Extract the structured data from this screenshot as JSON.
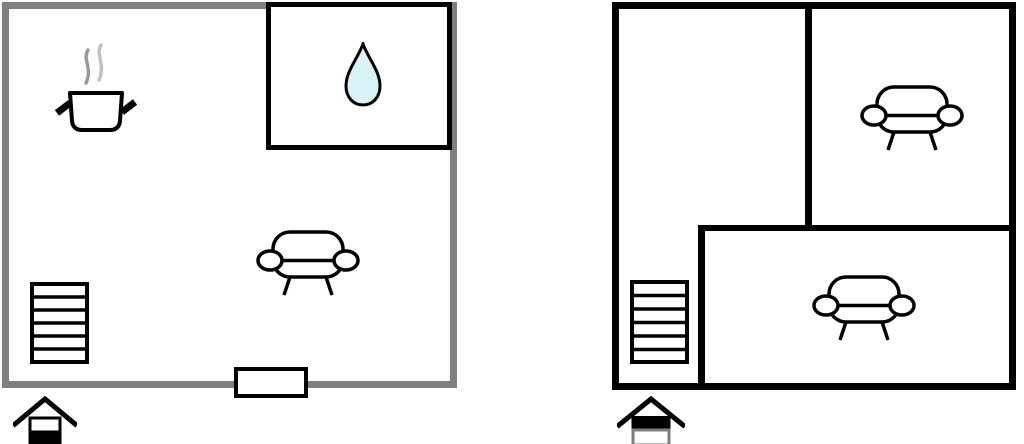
{
  "scene": {
    "name": "floor-plan-schematic",
    "background": "#ffffff"
  },
  "colors": {
    "wall_gray": "#7f7f7f",
    "wall_black": "#000000",
    "room_fill": "#ffffff",
    "water_drop_fill": "#d8f3f6",
    "steam_dark": "#999999",
    "steam_light": "#c2c2c2",
    "icon_stroke": "#000000"
  },
  "plans": [
    {
      "id": "ground-floor",
      "wall_style": "gray",
      "level_indicator": {
        "icon": "house-icon",
        "highlighted_level": "lower"
      },
      "rooms": [
        {
          "name": "main-room",
          "icons": [
            "cooking-pot-icon",
            "sofa-icon",
            "stairs-icon"
          ]
        },
        {
          "name": "bathroom",
          "icons": [
            "water-drop-icon"
          ]
        }
      ],
      "openings": [
        {
          "name": "entrance-door",
          "wall": "bottom"
        }
      ]
    },
    {
      "id": "upper-floor",
      "wall_style": "black",
      "level_indicator": {
        "icon": "house-icon",
        "highlighted_level": "upper"
      },
      "rooms": [
        {
          "name": "left-room",
          "icons": [
            "stairs-icon"
          ]
        },
        {
          "name": "top-right-room",
          "icons": [
            "sofa-icon"
          ]
        },
        {
          "name": "bottom-room",
          "icons": [
            "sofa-icon"
          ]
        }
      ],
      "openings": []
    }
  ]
}
